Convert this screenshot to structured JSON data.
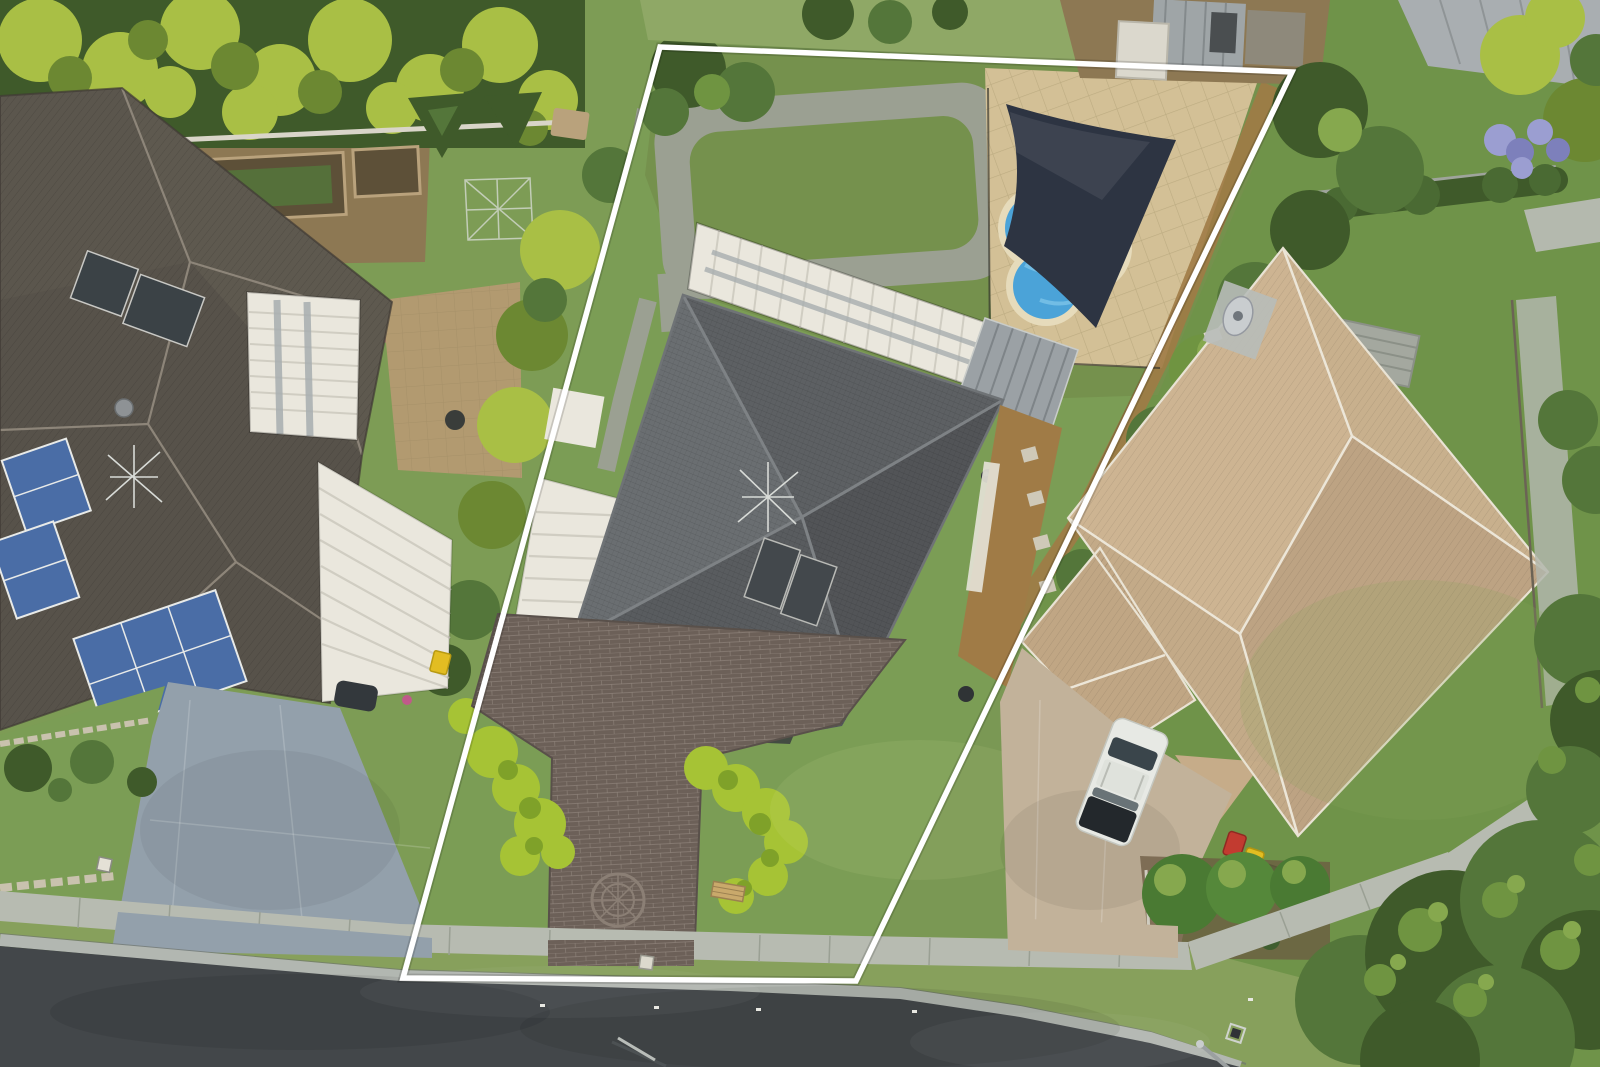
{
  "meta": {
    "type": "aerial-photograph",
    "description": "Top-down drone photograph of a suburban residential street. The middle property is outlined with a white real-estate boundary line. It has a dark grey hipped-roof house, brick paved driveway with circular compass medallion, bright sculpted hedges, a white carport and patio awning, a backyard lawn ringed by a concrete path, and a fenced pool area with a dark shade sail over a blue pool cover. The left neighbour has a brown-grey tiled roof with blue solar panels and a large blue-grey concrete driveway; the right neighbour has a tan tiled roof with white ridge capping, a tan driveway with a white car and three wheelie bins. An asphalt road with concrete gutter, footpath and grass verge runs along the bottom; dense tree canopies fill the bottom-right corner."
  },
  "boundary": {
    "name": "property-boundary-outline",
    "stroke_color": "#ffffff",
    "shape": "quadrilateral"
  },
  "objects": [
    {
      "name": "road",
      "label": "asphalt street"
    },
    {
      "name": "road-gutter",
      "label": "concrete kerb and gutter"
    },
    {
      "name": "footpath",
      "label": "concrete footpath"
    },
    {
      "name": "grass-verge",
      "label": "grass verge"
    },
    {
      "name": "left-house-roof",
      "label": "left neighbour tiled roof"
    },
    {
      "name": "left-solar-panels",
      "label": "blue photovoltaic arrays"
    },
    {
      "name": "left-solar-hot-water",
      "label": "dark solar hot water panels"
    },
    {
      "name": "left-pergola",
      "label": "white pergola with skylights"
    },
    {
      "name": "left-carport",
      "label": "white corrugated carport"
    },
    {
      "name": "left-driveway",
      "label": "blue-grey concrete driveway"
    },
    {
      "name": "center-house-roof",
      "label": "dark grey hipped roof"
    },
    {
      "name": "center-carport",
      "label": "white carport roof"
    },
    {
      "name": "center-pergola",
      "label": "white patio awning"
    },
    {
      "name": "grey-pergola",
      "label": "grey slatted pergola"
    },
    {
      "name": "brick-driveway",
      "label": "brick paved driveway"
    },
    {
      "name": "driveway-medallion",
      "label": "circular compass paving medallion"
    },
    {
      "name": "hedge-left",
      "label": "bright sculpted hedge"
    },
    {
      "name": "hedge-right",
      "label": "bright sculpted hedge"
    },
    {
      "name": "backyard-path-loop",
      "label": "concrete path loop around lawn"
    },
    {
      "name": "pool",
      "label": "swimming pool with blue cover"
    },
    {
      "name": "shade-sail",
      "label": "dark shade sail"
    },
    {
      "name": "pool-paving",
      "label": "tan square pool paving"
    },
    {
      "name": "garden-bench",
      "label": "small timber bench"
    },
    {
      "name": "right-house-roof",
      "label": "tan tiled roof with white ridge caps"
    },
    {
      "name": "right-driveway",
      "label": "tan concrete driveway"
    },
    {
      "name": "white-car",
      "label": "white station wagon"
    },
    {
      "name": "wheelie-bins",
      "label": "red, yellow and green wheelie bins"
    },
    {
      "name": "round-shrubs",
      "label": "clipped round shrubs"
    },
    {
      "name": "garden-steps",
      "label": "garden steps and retaining wall"
    },
    {
      "name": "clothesline",
      "label": "rotary clothesline"
    },
    {
      "name": "vegetable-beds",
      "label": "timber edged garden beds"
    },
    {
      "name": "palm-canopy",
      "label": "palm tree canopy"
    },
    {
      "name": "tree-canopy",
      "label": "large tree canopies"
    },
    {
      "name": "purple-flower-bush",
      "label": "purple flowering shrub"
    },
    {
      "name": "old-sheds",
      "label": "weathered sheds behind rear fence"
    },
    {
      "name": "road-reflectors",
      "label": "white pavement reflector dots"
    },
    {
      "name": "street-light-pole",
      "label": "street light pole"
    },
    {
      "name": "drain-grate",
      "label": "storm water grate"
    }
  ],
  "colors": {
    "base_grass": "#7a9854",
    "lawn_left": "#7d9c55",
    "lawn_center_front": "#7b9d55",
    "lawn_center_back": "#75914d",
    "lawn_right": "#6f9349",
    "lawn_pale": "#8fa866",
    "verge_grass": "#87a05c",
    "road_asphalt": "#43474a",
    "road_gutter": "#b2b7b1",
    "curb_shadow": "#6f756e",
    "sidewalk": "#b7bbb1",
    "sidewalk_seam": "#9aa094",
    "driveway_left_concrete": "#93a0ab",
    "driveway_right_concrete": "#c2b29a",
    "driveway_brick": "#6c6058",
    "brick_joint": "#9b9087",
    "roof_left": "#57524a",
    "roof_left_light": "#655e54",
    "roof_left_ridge": "#8d8579",
    "roof_center_nw": "#6a6e71",
    "roof_center_ne": "#5d6063",
    "roof_center_se": "#525457",
    "roof_center_sw": "#595c5f",
    "roof_center_low": "#54575a",
    "roof_center_ridge": "#7e8285",
    "roof_right": "#c3aa88",
    "roof_right_a": "#c8b08d",
    "roof_right_b": "#bda383",
    "roof_right_c": "#cdb492",
    "roof_right_ridge": "#ece6d8",
    "white_roof": "#eae7dd",
    "white_roof_rib": "#d0cdc2",
    "pergola_gray": "#9ba1a5",
    "pergola_slat": "#7e8488",
    "skylight_gray": "#a8aeb0",
    "pool_water": "#4ba3d8",
    "pool_water_light": "#7cc3e8",
    "pool_coping": "#e6dbbb",
    "pool_pavers": "#d3c096",
    "paver_joint": "#b9a87e",
    "shade_sail": "#2d3442",
    "mulch": "#a07b46",
    "soil": "#8d7853",
    "garden_bed_soil": "#5d5038",
    "bed_plants": "#55703a",
    "timber_edge": "#b9a27c",
    "hedge_bright": "#a6c335",
    "hedge_bright_dark": "#7fa129",
    "tree_dark": "#3f5a2a",
    "tree_mid": "#54763a",
    "tree_light": "#6f9441",
    "tree_highlight": "#86a84e",
    "palm_bright": "#a9bf45",
    "palm_shadow": "#6c8832",
    "solar_pv_blue": "#4a6da6",
    "solar_pv_frame": "#e8eae8",
    "solar_hw_dark": "#3b4246",
    "boundary_line": "#ffffff",
    "fence_white": "#d9d5c9",
    "retaining_wall": "#c9c2ae",
    "steps_concrete": "#a4a89f",
    "car_white": "#e7e9e4",
    "car_glass": "#3a454b",
    "car_tonneau": "#23282c",
    "bin_red": "#c23b30",
    "bin_yellow": "#e2bd22",
    "bin_green": "#3e6e33",
    "purple_flowers": "#9b9ed1",
    "purple_deep": "#7d80bb",
    "brick_path_red": "#a1766b",
    "patio_pavers": "#b29a70",
    "patio_joint": "#9c8761",
    "bbq_dark": "#3a3d3a",
    "utility_gray": "#c9cdcf",
    "shed_gray": "#9fa5a7",
    "shed_roof_gray": "#a9aeb1",
    "shed_white": "#dbd8cd",
    "shed_wood": "#8e897b",
    "antenna_white": "#d8dbd7",
    "stone_pale": "#cfc9b8",
    "porch_dark": "#3a3d3f",
    "dark_car": "#33383c",
    "path_concrete": "#9ba092"
  }
}
